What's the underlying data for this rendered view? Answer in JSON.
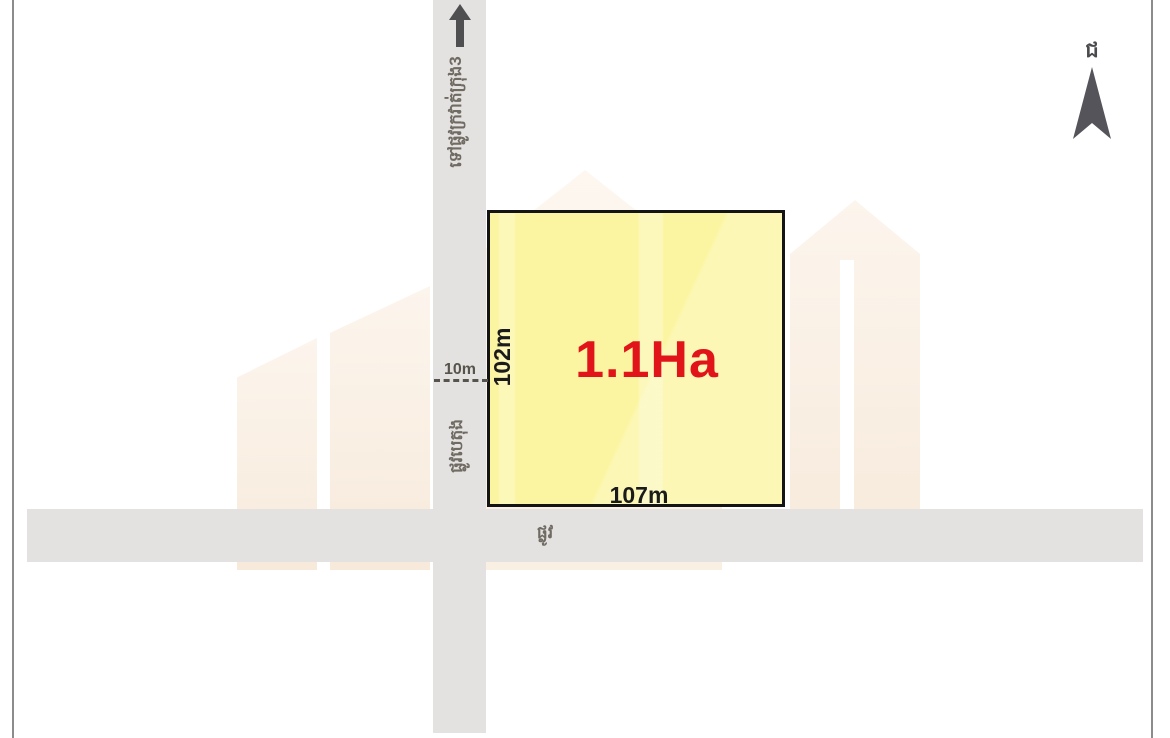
{
  "diagram": {
    "plot": {
      "area_label": "1.1Ha",
      "side_left_label": "102m",
      "side_bottom_label": "107m",
      "fill_color": "#FBF5A1",
      "border_color": "#141414",
      "area_text_color": "#E01419"
    },
    "vertical_road": {
      "destination_label": "ទៅផ្លូវក្រវាត់ក្រុង3",
      "name_label": "ផ្លូវបេតុង",
      "width_label": "10m"
    },
    "horizontal_road": {
      "name_label": "ផ្លូវ"
    },
    "compass": {
      "north_label": "ជ"
    },
    "colors": {
      "road": "#E4E2E0",
      "frame": "#8C8C8C",
      "watermark_light": "#FCF5ED",
      "watermark_deep": "#F7EADB",
      "annotation_gray": "#6F6B63"
    }
  }
}
